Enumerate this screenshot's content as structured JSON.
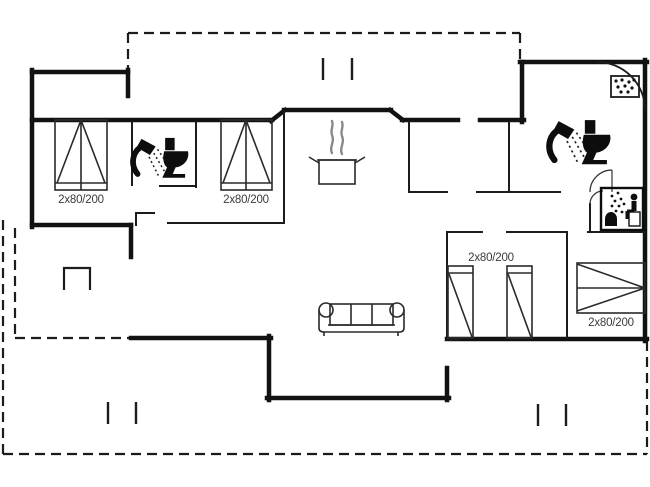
{
  "plan": {
    "type": "house-floor-plan",
    "beds": [
      {
        "room": "bedroom-northwest",
        "label": "2x80/200"
      },
      {
        "room": "bedroom-north-center",
        "label": "2x80/200"
      },
      {
        "room": "bedroom-south-center",
        "label": "2x80/200"
      },
      {
        "room": "bedroom-southeast",
        "label": "2x80/200"
      }
    ],
    "icons": [
      "shower-icon",
      "toilet-icon",
      "cooking-pot-icon",
      "sauna-icon",
      "corner-shower-icon",
      "sofa",
      "terrace-grill-icon"
    ],
    "colors": {
      "wall": "#121212",
      "background": "#ffffff",
      "label_text": "#3a3a3a",
      "steam_gray": "#8a8a8a"
    }
  }
}
